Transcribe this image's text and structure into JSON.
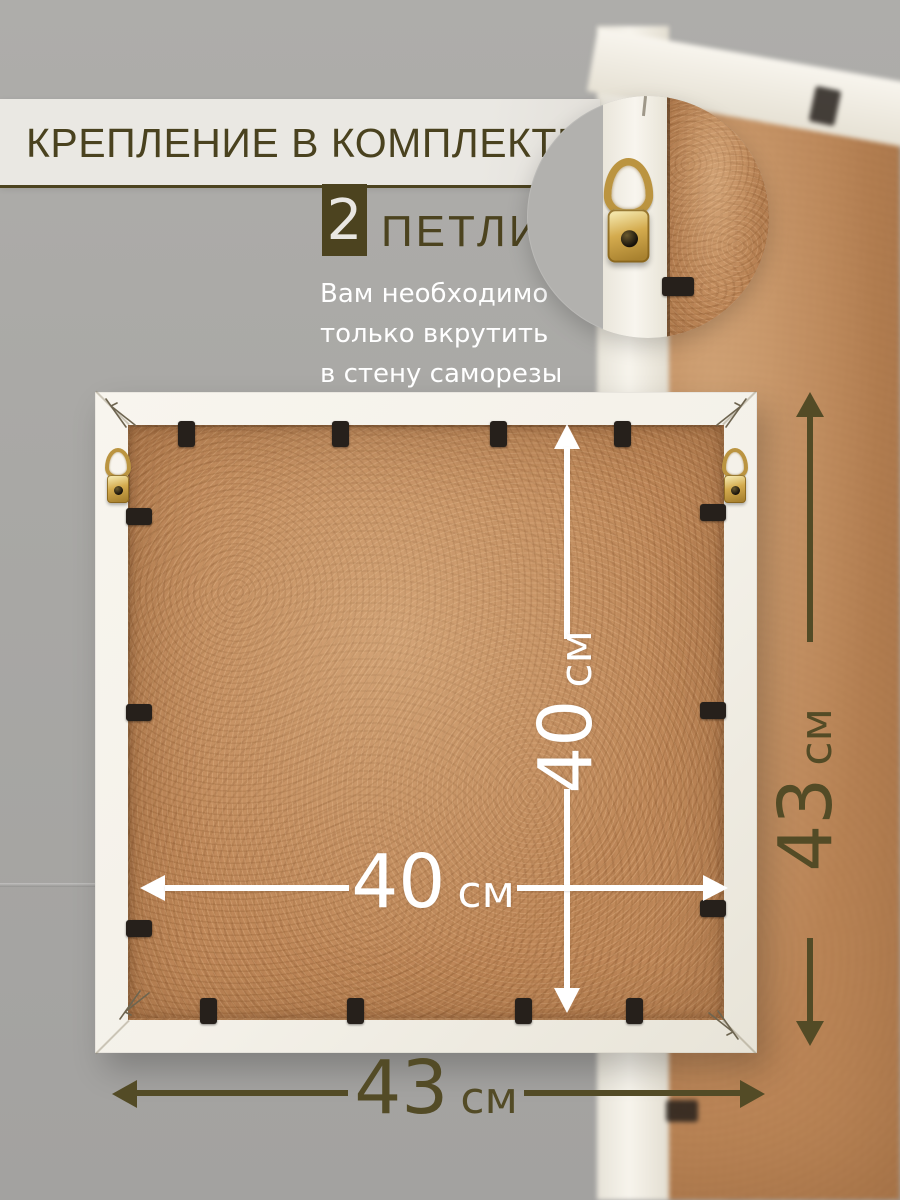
{
  "header": {
    "title": "КРЕПЛЕНИЕ В КОМПЛЕКТЕ"
  },
  "hardware": {
    "count": "2",
    "count_label": "ПЕТЛИ",
    "description_lines": [
      "Вам необходимо",
      "только вкрутить",
      "в стену саморезы"
    ]
  },
  "dimensions": {
    "inner_height": {
      "value": "40",
      "unit": "см"
    },
    "inner_width": {
      "value": "40",
      "unit": "см"
    },
    "outer_height": {
      "value": "43",
      "unit": "см"
    },
    "outer_width": {
      "value": "43",
      "unit": "см"
    }
  },
  "colors": {
    "accent_olive": "#534b26",
    "background_gray": "#a9a8a5",
    "band_light": "#eae8e3",
    "frame_white": "#f4f1e9",
    "mdf_brown": "#c0895a",
    "brass_gold": "#c9a54e",
    "clip_black": "#26201b",
    "dimension_white": "#ffffff"
  }
}
